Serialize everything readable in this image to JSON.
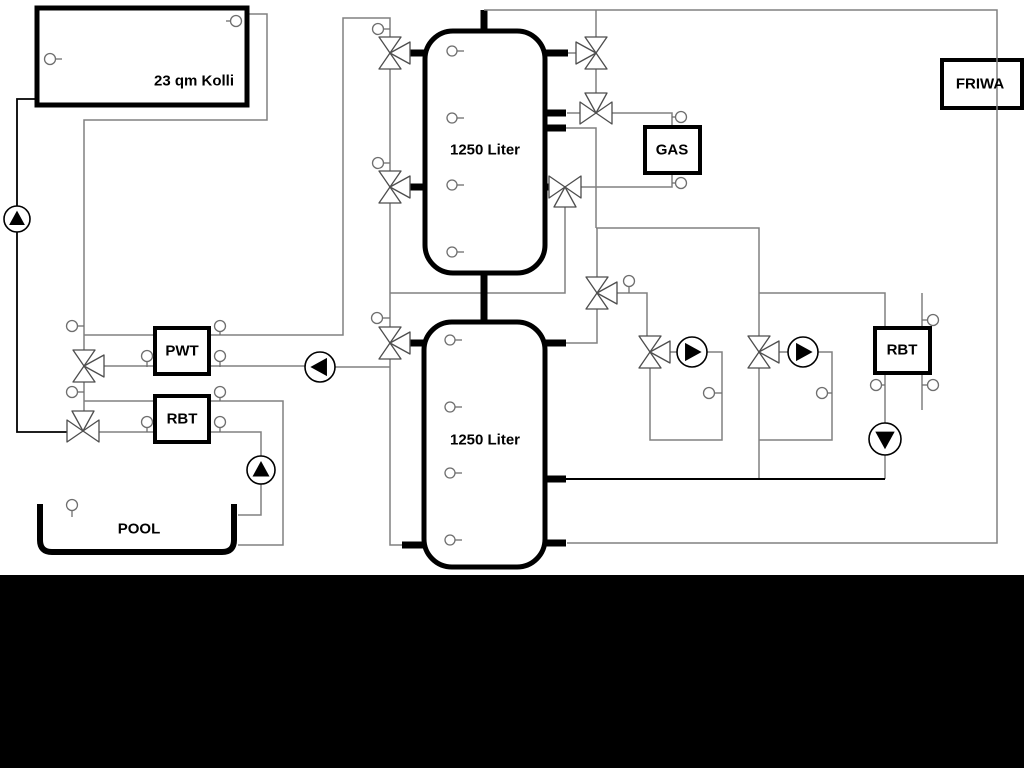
{
  "diagram": {
    "labels": {
      "collector": "23 qm Kolli",
      "tank1": "1250 Liter",
      "tank2": "1250 Liter",
      "pwt": "PWT",
      "rbt_left": "RBT",
      "gas": "GAS",
      "friwa": "FRIWA",
      "rbt_right": "RBT",
      "pool": "POOL"
    },
    "colors": {
      "pipe_gray": "#808080",
      "pipe_black": "#000000",
      "background": "#ffffff",
      "bottom_band": "#000000"
    }
  }
}
